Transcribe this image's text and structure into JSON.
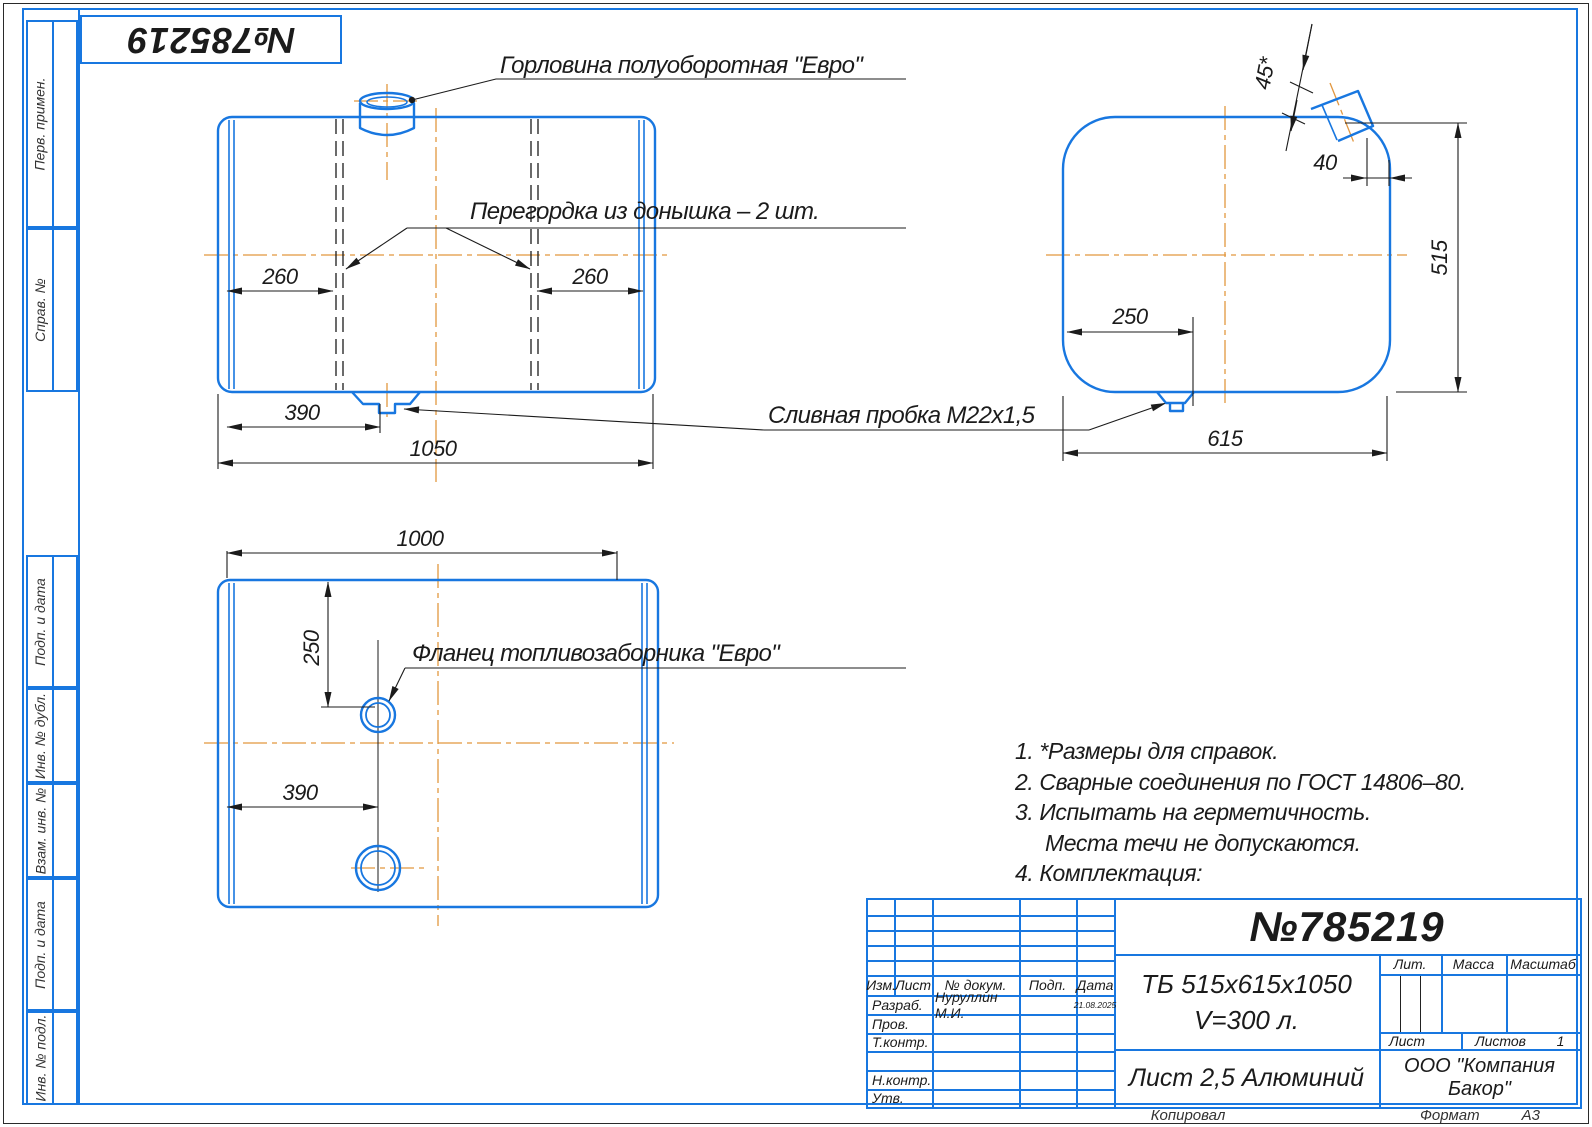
{
  "corner_stamp": {
    "number": "№785219"
  },
  "left_strip": {
    "items": [
      {
        "label": "Перв. примен."
      },
      {
        "label": "Справ. №"
      },
      {
        "label": "Подп. и дата"
      },
      {
        "label": "Инв. № дубл."
      },
      {
        "label": "Взам. инв. №"
      },
      {
        "label": "Подп. и дата"
      },
      {
        "label": "Инв. № подл."
      }
    ]
  },
  "callouts": {
    "filler_neck": "Горловина полуоборотная \"Евро\"",
    "baffle": "Перегордка из донышка – 2 шт.",
    "drain_plug": "Сливная пробка М22х1,5",
    "fuel_flange": "Фланец топливозаборника \"Евро\""
  },
  "dimensions": {
    "front": {
      "baffle_left": "260",
      "baffle_right": "260",
      "drain_x": "390",
      "length": "1050"
    },
    "side": {
      "neck_angle": "45*",
      "neck_offset": "40",
      "height": "515",
      "drain_x": "250",
      "width": "615"
    },
    "bottom": {
      "length": "1000",
      "flange_y": "250",
      "flange_x": "390"
    }
  },
  "notes": {
    "lines": [
      "1. *Размеры для справок.",
      "2. Сварные соединения по ГОСТ 14806–80.",
      "3. Испытать на герметичность.",
      "Места течи не допускаются.",
      "4. Комплектация:"
    ]
  },
  "title_block": {
    "doc_number": "№785219",
    "designation_line1": "ТБ 515х615х1050",
    "designation_line2": "V=300 л.",
    "material": "Лист 2,5 Алюминий",
    "company": "ООО \"Компания Бакор\"",
    "headers": {
      "izm": "Изм.",
      "list": "Лист",
      "doc": "№ докум.",
      "sign": "Подп.",
      "date": "Дата",
      "lit": "Лит.",
      "mass": "Масса",
      "scale": "Масштаб",
      "sheet": "Лист",
      "sheets": "Листов",
      "sheets_value": "1"
    },
    "rows": [
      {
        "label": "Разраб.",
        "name": "Нуруллин М.И.",
        "date": "21.08.2025"
      },
      {
        "label": "Пров."
      },
      {
        "label": "Т.контр."
      },
      {
        "label": "Н.контр."
      },
      {
        "label": "Утв."
      }
    ]
  },
  "footer": {
    "copied": "Копировал",
    "format_label": "Формат",
    "format_value": "А3"
  }
}
